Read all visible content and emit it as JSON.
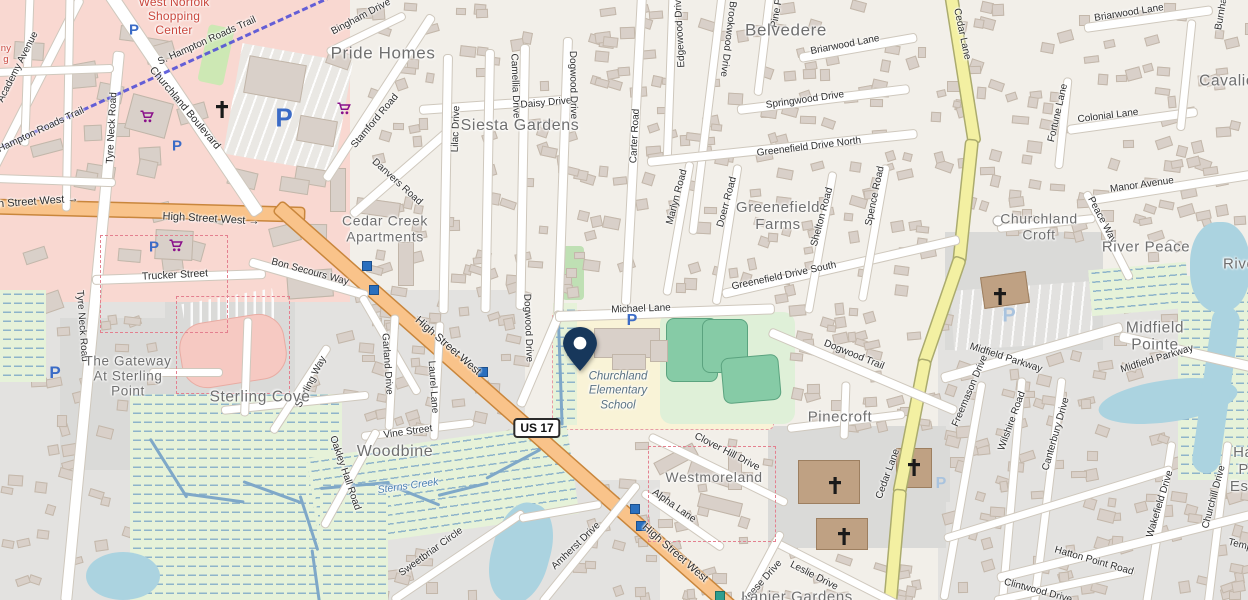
{
  "map_type": "openstreetmap-carto",
  "colors": {
    "land": "#f2efe9",
    "residential_gray": "#e3e2e0",
    "retail_pink": "#f9d8d1",
    "school_yellow": "#f9f3d7",
    "pitch_green": "#86cba6",
    "marsh_green": "#e6f2d9",
    "water": "#abd3e0",
    "trunk_road_orange": "#f9c38a",
    "secondary_road_yellow": "#f3f0a2",
    "trail_blue": "#4b49d8",
    "pin_navy": "#17375b",
    "parking_blue": "#3b6bc6",
    "cart_purple": "#8a0f8a",
    "place_label_gray": "#6f6f6f",
    "shopping_label_red": "#c9473d"
  },
  "pin": {
    "x": 580,
    "y": 371,
    "label": "dropped-pin"
  },
  "shield": {
    "text": "US 17",
    "x": 537,
    "y": 428
  },
  "street_labels": [
    {
      "t": "High Street West →",
      "x": 30,
      "y": 202,
      "r": -4,
      "s": 11
    },
    {
      "t": "High Street West →",
      "x": 211,
      "y": 219,
      "r": 3,
      "s": 11
    },
    {
      "t": "High Street West",
      "x": 448,
      "y": 346,
      "r": 41,
      "s": 11
    },
    {
      "t": "High Street West",
      "x": 675,
      "y": 553,
      "r": 41,
      "s": 11
    },
    {
      "t": "S. Hampton Roads Trail",
      "x": 207,
      "y": 41,
      "r": -24
    },
    {
      "t": "Hampton Roads Trail",
      "x": 41,
      "y": 130,
      "r": -25
    },
    {
      "t": "Academy Avenue",
      "x": 18,
      "y": 67,
      "r": -63
    },
    {
      "t": "Tyre Neck Road",
      "x": 112,
      "y": 128,
      "r": -87
    },
    {
      "t": "Tyre Neck Road",
      "x": 82,
      "y": 326,
      "r": 86
    },
    {
      "t": "Churchland Boulevard",
      "x": 185,
      "y": 108,
      "r": 50,
      "s": 10.5
    },
    {
      "t": "Bingham Drive",
      "x": 361,
      "y": 17,
      "r": -28
    },
    {
      "t": "Stamford Road",
      "x": 375,
      "y": 121,
      "r": -50
    },
    {
      "t": "Danvers Road",
      "x": 397,
      "y": 182,
      "r": 42
    },
    {
      "t": "Trucker Street",
      "x": 175,
      "y": 275,
      "r": -3,
      "s": 10.5
    },
    {
      "t": "Bon Secours Way",
      "x": 310,
      "y": 272,
      "r": 15
    },
    {
      "t": "Lilac Drive",
      "x": 456,
      "y": 129,
      "r": -88
    },
    {
      "t": "Camellia Drive",
      "x": 515,
      "y": 86,
      "r": 88
    },
    {
      "t": "Daisy Drive",
      "x": 546,
      "y": 103,
      "r": -5
    },
    {
      "t": "Dogwood Drive",
      "x": 573,
      "y": 85,
      "r": 89
    },
    {
      "t": "Dogwood Drive",
      "x": 528,
      "y": 328,
      "r": 88
    },
    {
      "t": "Carter Road",
      "x": 635,
      "y": 136,
      "r": -87
    },
    {
      "t": "Edgewood Drive",
      "x": 680,
      "y": 31,
      "r": -93
    },
    {
      "t": "Brookwood Drive",
      "x": 728,
      "y": 39,
      "r": 97
    },
    {
      "t": "Pine Pl",
      "x": 777,
      "y": 12,
      "r": -80
    },
    {
      "t": "Briarwood Lane",
      "x": 845,
      "y": 45,
      "r": -11
    },
    {
      "t": "Briarwood Lane",
      "x": 1129,
      "y": 13,
      "r": -9
    },
    {
      "t": "Springwood Drive",
      "x": 805,
      "y": 100,
      "r": -8
    },
    {
      "t": "Greenefield Drive North",
      "x": 809,
      "y": 147,
      "r": -7
    },
    {
      "t": "Cedar Lane",
      "x": 962,
      "y": 34,
      "r": 78
    },
    {
      "t": "Cedar Lane",
      "x": 888,
      "y": 474,
      "r": -70
    },
    {
      "t": "Fortune Lane",
      "x": 1058,
      "y": 113,
      "r": -77
    },
    {
      "t": "Colonial Lane",
      "x": 1108,
      "y": 116,
      "r": -7
    },
    {
      "t": "Manor Avenue",
      "x": 1142,
      "y": 185,
      "r": -8
    },
    {
      "t": "Peace Way",
      "x": 1102,
      "y": 220,
      "r": 62
    },
    {
      "t": "Marlyn Road",
      "x": 677,
      "y": 197,
      "r": -75
    },
    {
      "t": "Doerr Road",
      "x": 727,
      "y": 202,
      "r": -75
    },
    {
      "t": "Shelton Road",
      "x": 822,
      "y": 217,
      "r": -75
    },
    {
      "t": "Spence Road",
      "x": 875,
      "y": 196,
      "r": -78
    },
    {
      "t": "Greenefield Drive South",
      "x": 784,
      "y": 276,
      "r": -12
    },
    {
      "t": "Michael Lane",
      "x": 641,
      "y": 309,
      "r": -2
    },
    {
      "t": "Dogwood Trail",
      "x": 854,
      "y": 355,
      "r": 22
    },
    {
      "t": "Midfield Parkway",
      "x": 1006,
      "y": 358,
      "r": 18
    },
    {
      "t": "Midfield Parkway",
      "x": 1157,
      "y": 359,
      "r": -17
    },
    {
      "t": "Freemason Drive",
      "x": 970,
      "y": 391,
      "r": -67
    },
    {
      "t": "Wilshire Road",
      "x": 1012,
      "y": 421,
      "r": -70
    },
    {
      "t": "Canterbury Drive",
      "x": 1056,
      "y": 434,
      "r": -74
    },
    {
      "t": "Wakefield Drive",
      "x": 1160,
      "y": 504,
      "r": -73
    },
    {
      "t": "Churchill Drive",
      "x": 1214,
      "y": 497,
      "r": -75
    },
    {
      "t": "Hatton Point Road",
      "x": 1094,
      "y": 561,
      "r": 16
    },
    {
      "t": "Clintwood Drive",
      "x": 1038,
      "y": 591,
      "r": 15
    },
    {
      "t": "Garland Drive",
      "x": 387,
      "y": 364,
      "r": 86
    },
    {
      "t": "Laurel Lane",
      "x": 433,
      "y": 387,
      "r": 86
    },
    {
      "t": "Vine Street",
      "x": 408,
      "y": 432,
      "r": -8
    },
    {
      "t": "Oakley Hall Road",
      "x": 345,
      "y": 473,
      "r": 71
    },
    {
      "t": "Sweetbriar Circle",
      "x": 431,
      "y": 552,
      "r": -36
    },
    {
      "t": "Amherst Drive",
      "x": 576,
      "y": 546,
      "r": -44
    },
    {
      "t": "Clover Hill Drive",
      "x": 727,
      "y": 452,
      "r": 27
    },
    {
      "t": "Alpha Lane",
      "x": 674,
      "y": 506,
      "r": 35
    },
    {
      "t": "Reese Drive",
      "x": 762,
      "y": 582,
      "r": -48
    },
    {
      "t": "Leslie Drive",
      "x": 814,
      "y": 576,
      "r": 27
    },
    {
      "t": "Sterling Way",
      "x": 311,
      "y": 382,
      "r": -63
    },
    {
      "t": "Temple",
      "x": 1244,
      "y": 546,
      "r": 14
    },
    {
      "t": "Burnham",
      "x": 1222,
      "y": 10,
      "r": -80
    }
  ],
  "place_labels": [
    {
      "t": "West Norfolk\nShopping\nCenter",
      "x": 174,
      "y": 16,
      "s": 12,
      "cls": "place-red"
    },
    {
      "t": "ny\ng",
      "x": 6,
      "y": 54,
      "s": 9.5,
      "cls": "place-red"
    },
    {
      "t": "Pride Homes",
      "x": 383,
      "y": 53,
      "s": 17,
      "cls": "place"
    },
    {
      "t": "Siesta Gardens",
      "x": 520,
      "y": 126,
      "s": 16,
      "cls": "place"
    },
    {
      "t": "Belvedere",
      "x": 786,
      "y": 30,
      "s": 17,
      "cls": "place"
    },
    {
      "t": "Greenefield\nFarms",
      "x": 778,
      "y": 217,
      "s": 15,
      "cls": "place"
    },
    {
      "t": "Cedar Creek\nApartments",
      "x": 385,
      "y": 229,
      "s": 14,
      "cls": "place"
    },
    {
      "t": "Cavalier",
      "x": 1230,
      "y": 81,
      "s": 15.5,
      "cls": "place"
    },
    {
      "t": "Churchland\nCroft",
      "x": 1039,
      "y": 227,
      "s": 14,
      "cls": "place"
    },
    {
      "t": "River Peace",
      "x": 1146,
      "y": 248,
      "s": 15,
      "cls": "place"
    },
    {
      "t": "River",
      "x": 1242,
      "y": 265,
      "s": 15,
      "cls": "place"
    },
    {
      "t": "Midfield Pointe",
      "x": 1155,
      "y": 337,
      "s": 15.5,
      "cls": "place"
    },
    {
      "t": "Pinecroft",
      "x": 840,
      "y": 418,
      "s": 15,
      "cls": "place"
    },
    {
      "t": "Westmoreland",
      "x": 714,
      "y": 478,
      "s": 14,
      "cls": "place"
    },
    {
      "t": "Woodbine",
      "x": 395,
      "y": 452,
      "s": 16,
      "cls": "place"
    },
    {
      "t": "Sterling Cove",
      "x": 260,
      "y": 397,
      "s": 15.5,
      "cls": "place"
    },
    {
      "t": "The Gateway\nAt Sterling\nPoint",
      "x": 128,
      "y": 376,
      "s": 13.5,
      "cls": "place"
    },
    {
      "t": "Lanier Gardens",
      "x": 797,
      "y": 598,
      "s": 15,
      "cls": "place"
    },
    {
      "t": "Hatton Point\nEstates",
      "x": 1257,
      "y": 470,
      "s": 15,
      "cls": "place"
    },
    {
      "t": "Churchland\nElementary\nSchool",
      "x": 618,
      "y": 391,
      "s": 11.5,
      "cls": "school-lbl"
    },
    {
      "t": "Sterns Creek",
      "x": 408,
      "y": 486,
      "s": 10.5,
      "cls": "water-lbl",
      "r": -8
    }
  ],
  "icons": [
    {
      "k": "parking",
      "x": 134,
      "y": 30,
      "s": 15
    },
    {
      "k": "parking",
      "x": 284,
      "y": 118,
      "s": 26
    },
    {
      "k": "parking",
      "x": 177,
      "y": 146,
      "s": 15
    },
    {
      "k": "parking",
      "x": 154,
      "y": 247,
      "s": 15
    },
    {
      "k": "parking",
      "x": 55,
      "y": 373,
      "s": 17
    },
    {
      "k": "parking",
      "x": 632,
      "y": 321,
      "s": 16
    },
    {
      "k": "parking-pale",
      "x": 1009,
      "y": 316,
      "s": 20
    },
    {
      "k": "parking-pale",
      "x": 941,
      "y": 484,
      "s": 16
    },
    {
      "k": "cart",
      "x": 147,
      "y": 119
    },
    {
      "k": "cart",
      "x": 344,
      "y": 111
    },
    {
      "k": "cart",
      "x": 176,
      "y": 248
    },
    {
      "k": "cross",
      "x": 222,
      "y": 112
    },
    {
      "k": "cross",
      "x": 1000,
      "y": 299
    },
    {
      "k": "cross",
      "x": 835,
      "y": 488
    },
    {
      "k": "cross",
      "x": 844,
      "y": 539
    },
    {
      "k": "cross",
      "x": 914,
      "y": 470
    },
    {
      "k": "bus-stop",
      "x": 367,
      "y": 266
    },
    {
      "k": "bus-stop",
      "x": 374,
      "y": 290
    },
    {
      "k": "bus-stop",
      "x": 483,
      "y": 372
    },
    {
      "k": "bus-stop",
      "x": 635,
      "y": 509
    },
    {
      "k": "bus-stop",
      "x": 641,
      "y": 526
    },
    {
      "k": "bus-stop-teal",
      "x": 720,
      "y": 596
    },
    {
      "k": "poi-dot",
      "x": 998,
      "y": 221
    },
    {
      "k": "poi-dot",
      "x": 1171,
      "y": 245
    }
  ]
}
